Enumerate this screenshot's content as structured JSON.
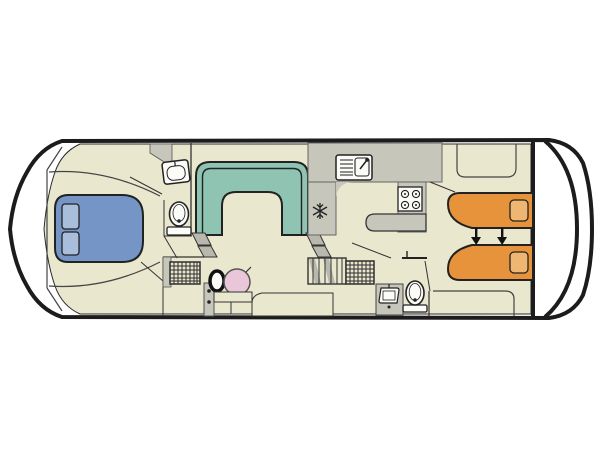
{
  "diagram": {
    "type": "boat-floorplan",
    "kind": "top-down deck plan of a canal cruiser",
    "visible_text": [],
    "arrow_count": 2
  },
  "colors": {
    "background": "#ffffff",
    "hull_white": "#ffffff",
    "outline": "#1c1c1c",
    "floor": "#eae7cf",
    "wall": "#c7c6bb",
    "step": "#b9b8ae",
    "bench_teal": "#8ec4b1",
    "bed_blue": "#7495c6",
    "pillow_blue": "#a9bedb",
    "bed_orange": "#e6933c",
    "pillow_orange": "#efb671",
    "wheel_pink": "#e9c7d8",
    "fixture_white": "#fbfbf7",
    "line_dark": "#333333",
    "arrow_black": "#111111"
  },
  "fixtures": [
    "bow-double-bed",
    "bow-pillows",
    "front-washbasin",
    "front-toilet",
    "front-shower-grid",
    "u-shaped-dinette-bench",
    "companionway-steps-left",
    "companionway-steps-right",
    "slatted-stairs",
    "galley-sink",
    "stove-4-burner",
    "fridge-snowflake",
    "galley-peninsula-counter",
    "helm-seat",
    "steering-wheel",
    "helm-steps",
    "aft-shower-grid",
    "aft-washbasin",
    "aft-toilet",
    "cabin-door-leaf",
    "aft-single-bed-top",
    "aft-single-bed-bottom",
    "aft-pillows",
    "bed-convert-arrows",
    "wardrobe-outline-top",
    "wardrobe-outline-bottom",
    "stern-transom-curves",
    "bow-point"
  ]
}
